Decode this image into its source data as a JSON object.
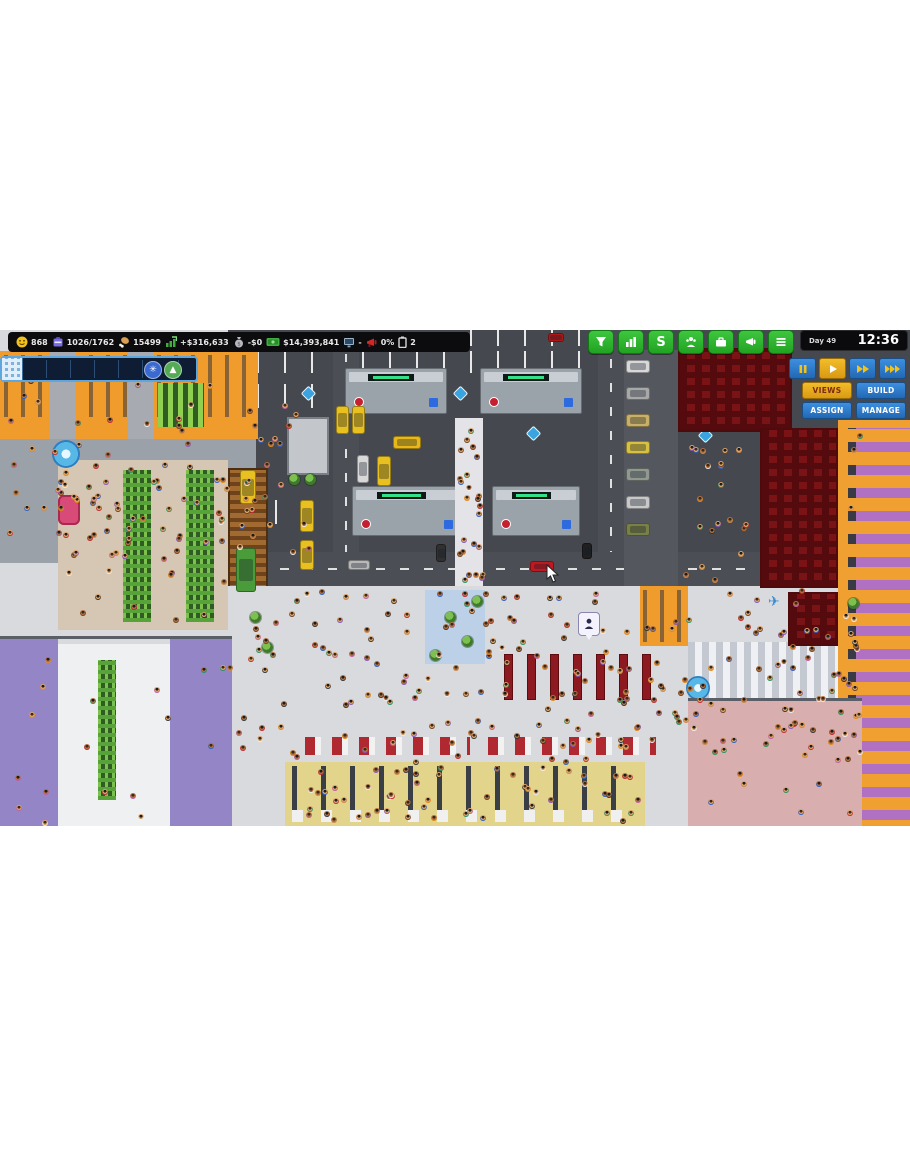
{
  "hud": {
    "stats": [
      {
        "icon": "passengers-smiley-icon",
        "value": "868"
      },
      {
        "icon": "bags-suitcase-icon",
        "value": "1026/1762"
      },
      {
        "icon": "food-drumstick-icon",
        "value": "15499"
      },
      {
        "icon": "income-arrow-icon",
        "value": "+$316,633"
      },
      {
        "icon": "expenses-moneybag-icon",
        "value": "-$0"
      },
      {
        "icon": "cash-bill-icon",
        "value": "$14,393,841"
      },
      {
        "icon": "monitor-icon",
        "value": "-"
      },
      {
        "icon": "marketing-megaphone-icon",
        "value": "0%"
      },
      {
        "icon": "battery-icon",
        "value": "2"
      }
    ],
    "clock": {
      "day": "Day 49",
      "time": "12:36"
    },
    "toolbar": [
      {
        "name": "filter"
      },
      {
        "name": "reports"
      },
      {
        "name": "finance",
        "glyph": "S"
      },
      {
        "name": "staff"
      },
      {
        "name": "business"
      },
      {
        "name": "marketing"
      },
      {
        "name": "main-menu"
      }
    ],
    "speed": [
      {
        "name": "pause",
        "active": false
      },
      {
        "name": "play",
        "active": true
      },
      {
        "name": "fast-forward",
        "active": false
      },
      {
        "name": "fastest",
        "active": false
      }
    ],
    "menus": [
      {
        "label": "VIEWS",
        "active": true
      },
      {
        "label": "BUILD",
        "active": false
      },
      {
        "label": "ASSIGN",
        "active": false
      },
      {
        "label": "MANAGE",
        "active": false
      }
    ]
  },
  "colors": {
    "toolbar_green": "#2db52d",
    "button_blue": "#2b7fd4",
    "button_yellow": "#e8a81c",
    "hud_black": "#0c0c0e",
    "seats_red": "#7a1316",
    "shop_orange": "#f09c2c",
    "room_purple": "#9486c6",
    "room_pink": "#d9aeae"
  },
  "scene": {
    "crowds": [
      {
        "x": 235,
        "y": 588,
        "w": 620,
        "h": 172,
        "n": 210
      },
      {
        "x": 2,
        "y": 440,
        "w": 250,
        "h": 116,
        "n": 55
      },
      {
        "x": 456,
        "y": 420,
        "w": 26,
        "h": 162,
        "n": 24
      },
      {
        "x": 292,
        "y": 764,
        "w": 348,
        "h": 54,
        "n": 55
      },
      {
        "x": 62,
        "y": 464,
        "w": 160,
        "h": 155,
        "n": 28
      },
      {
        "x": 250,
        "y": 402,
        "w": 58,
        "h": 148,
        "n": 16
      },
      {
        "x": 840,
        "y": 432,
        "w": 18,
        "h": 385,
        "n": 14
      },
      {
        "x": 682,
        "y": 442,
        "w": 75,
        "h": 140,
        "n": 20
      },
      {
        "x": 4,
        "y": 354,
        "w": 246,
        "h": 80,
        "n": 22
      },
      {
        "x": 692,
        "y": 702,
        "w": 165,
        "h": 118,
        "n": 18
      },
      {
        "x": 4,
        "y": 642,
        "w": 224,
        "h": 180,
        "n": 18
      }
    ],
    "vehicles": [
      {
        "x": 548,
        "y": 333,
        "w": 16,
        "h": 9,
        "c": "#b01818"
      },
      {
        "x": 622,
        "y": 333,
        "w": 16,
        "h": 9,
        "c": "#b01818"
      },
      {
        "x": 336,
        "y": 406,
        "w": 13,
        "h": 28,
        "c": "#e8c020"
      },
      {
        "x": 352,
        "y": 406,
        "w": 13,
        "h": 28,
        "c": "#e8c020"
      },
      {
        "x": 393,
        "y": 436,
        "w": 28,
        "h": 13,
        "c": "#e8b818"
      },
      {
        "x": 377,
        "y": 456,
        "w": 14,
        "h": 30,
        "c": "#e8c020"
      },
      {
        "x": 357,
        "y": 455,
        "w": 12,
        "h": 28,
        "c": "#d8d8d8"
      },
      {
        "x": 300,
        "y": 500,
        "w": 14,
        "h": 32,
        "c": "#e8c020"
      },
      {
        "x": 300,
        "y": 540,
        "w": 14,
        "h": 30,
        "c": "#e8c020"
      },
      {
        "x": 236,
        "y": 548,
        "w": 20,
        "h": 44,
        "c": "#4a9c3a"
      },
      {
        "x": 240,
        "y": 470,
        "w": 16,
        "h": 34,
        "c": "#e8c020"
      },
      {
        "x": 530,
        "y": 561,
        "w": 24,
        "h": 11,
        "c": "#c01820"
      },
      {
        "x": 436,
        "y": 544,
        "w": 10,
        "h": 18,
        "c": "#303030"
      },
      {
        "x": 582,
        "y": 543,
        "w": 10,
        "h": 16,
        "c": "#202020"
      },
      {
        "x": 348,
        "y": 560,
        "w": 22,
        "h": 10,
        "c": "#b8b8b8"
      },
      {
        "x": 626,
        "y": 360,
        "w": 24,
        "h": 13,
        "c": "#d8d8d8"
      },
      {
        "x": 626,
        "y": 387,
        "w": 24,
        "h": 13,
        "c": "#a8a8a8"
      },
      {
        "x": 626,
        "y": 414,
        "w": 24,
        "h": 13,
        "c": "#c8b068"
      },
      {
        "x": 626,
        "y": 441,
        "w": 24,
        "h": 13,
        "c": "#d8c040"
      },
      {
        "x": 626,
        "y": 468,
        "w": 24,
        "h": 13,
        "c": "#909890"
      },
      {
        "x": 626,
        "y": 496,
        "w": 24,
        "h": 13,
        "c": "#c8c8c8"
      },
      {
        "x": 626,
        "y": 523,
        "w": 24,
        "h": 13,
        "c": "#788048"
      }
    ],
    "trees": [
      {
        "x": 445,
        "y": 612
      },
      {
        "x": 462,
        "y": 636
      },
      {
        "x": 430,
        "y": 650
      },
      {
        "x": 472,
        "y": 596
      },
      {
        "x": 250,
        "y": 612
      },
      {
        "x": 262,
        "y": 642
      },
      {
        "x": 848,
        "y": 598
      },
      {
        "x": 289,
        "y": 474
      },
      {
        "x": 305,
        "y": 474
      }
    ],
    "shuttle_markers": [
      {
        "x": 88,
        "y": 369
      },
      {
        "x": 148,
        "y": 369
      },
      {
        "x": 303,
        "y": 388
      },
      {
        "x": 455,
        "y": 388
      },
      {
        "x": 528,
        "y": 428
      }
    ],
    "benches": {
      "x0": 504,
      "y": 654,
      "n": 7,
      "dx": 23,
      "w": 9,
      "h": 46
    },
    "pin": {
      "x": 578,
      "y": 612
    },
    "cursor": {
      "x": 546,
      "y": 564
    },
    "person_shirts": [
      "#c02830",
      "#3060c0",
      "#2a9060",
      "#eeeeee",
      "#e08818",
      "#8858b8",
      "#333333",
      "#c060a0",
      "#c98a4b",
      "#6b4226"
    ]
  }
}
